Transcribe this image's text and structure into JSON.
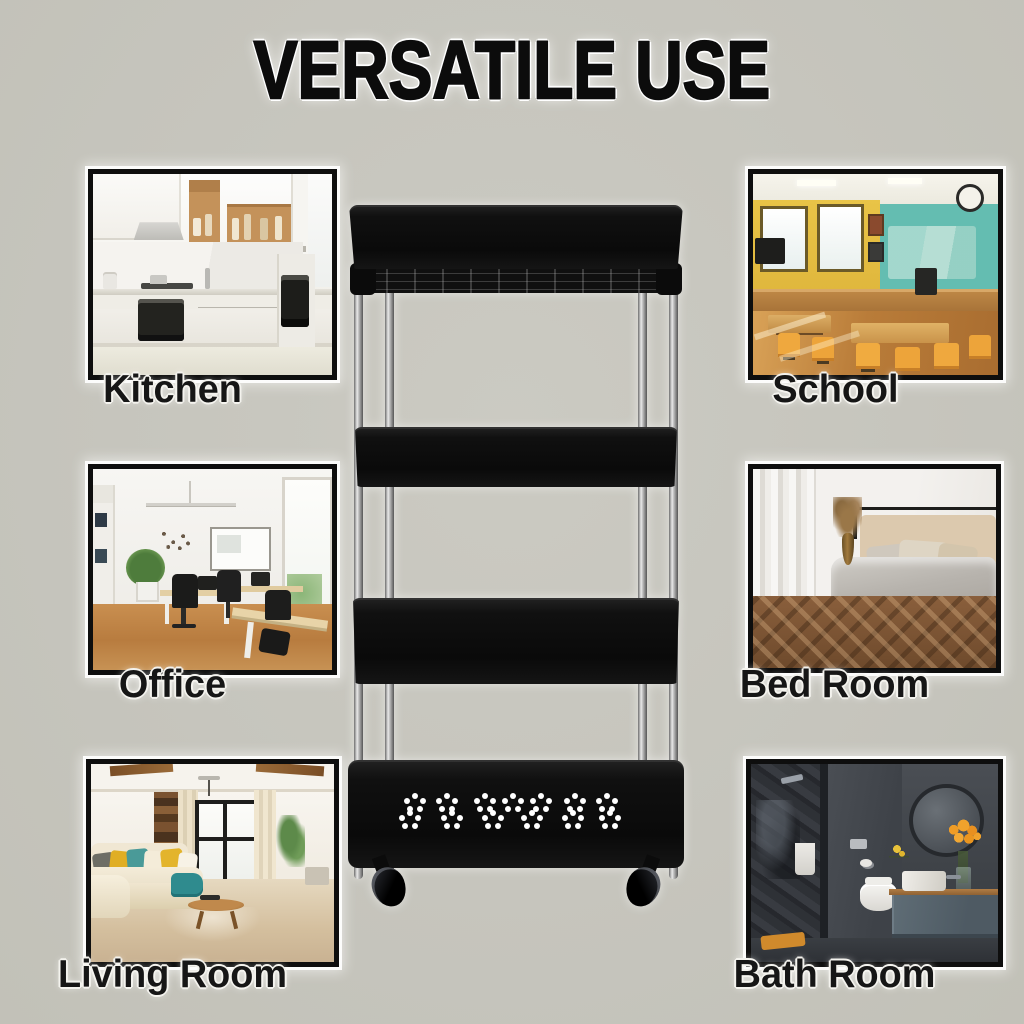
{
  "title": "VERSATILE USE",
  "rooms": [
    {
      "id": "kitchen",
      "label": "Kitchen"
    },
    {
      "id": "school",
      "label": "School"
    },
    {
      "id": "office",
      "label": "Office"
    },
    {
      "id": "bedroom",
      "label": "Bed Room"
    },
    {
      "id": "living-room",
      "label": "Living Room"
    },
    {
      "id": "bathroom",
      "label": "Bath Room"
    }
  ],
  "colors": {
    "background": "#c6c5bd",
    "text": "#0c0c0c",
    "label_halo": "#ffffff",
    "frame_border": "#0e0e0e",
    "cart_black": "#0a0a0a",
    "cart_chrome": "#d9d9d9"
  }
}
